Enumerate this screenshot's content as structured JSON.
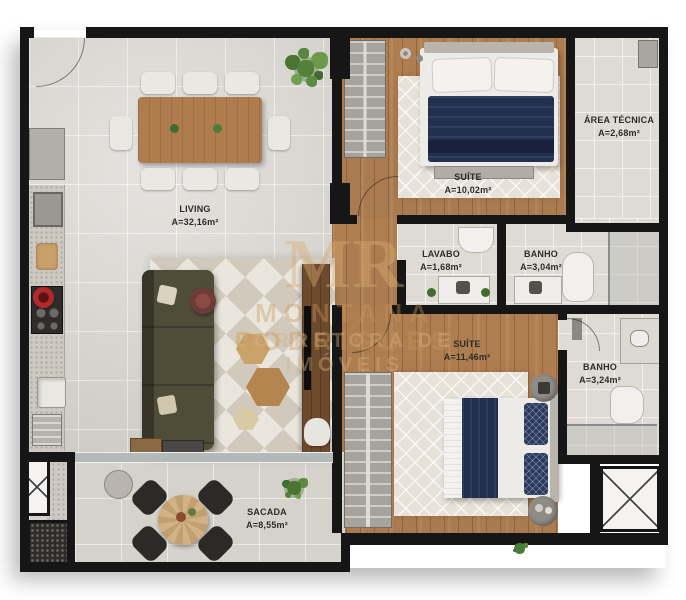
{
  "watermark": {
    "monogram": "MR",
    "line1": "MONTANA RODRIGUES",
    "line2": "CORRETORA DE IMÓVEIS"
  },
  "rooms": [
    {
      "id": "living",
      "name": "LIVING",
      "area": "A=32,16m²"
    },
    {
      "id": "suite-1",
      "name": "SUÍTE",
      "area": "A=10,02m²"
    },
    {
      "id": "area-tecnica",
      "name": "ÁREA TÉCNICA",
      "area": "A=2,68m²"
    },
    {
      "id": "lavabo",
      "name": "LAVABO",
      "area": "A=1,68m²"
    },
    {
      "id": "banho-1",
      "name": "BANHO",
      "area": "A=3,04m²"
    },
    {
      "id": "suite-2",
      "name": "SUÍTE",
      "area": "A=11,46m²"
    },
    {
      "id": "banho-2",
      "name": "BANHO",
      "area": "A=3,24m²"
    },
    {
      "id": "sacada",
      "name": "SACADA",
      "area": "A=8,55m²"
    }
  ],
  "colors": {
    "wall": "#161616",
    "wood_floor": "#b9895b",
    "tile_floor": "#dad7d1",
    "bath_tile": "#dedbd5",
    "balcony_tile": "#d5d2cb",
    "navy_bedding": "#22304f",
    "sofa_olive": "#4f4c38",
    "rug_tan": "#d1c9bc",
    "watermark_tan": "#cd9e60"
  }
}
